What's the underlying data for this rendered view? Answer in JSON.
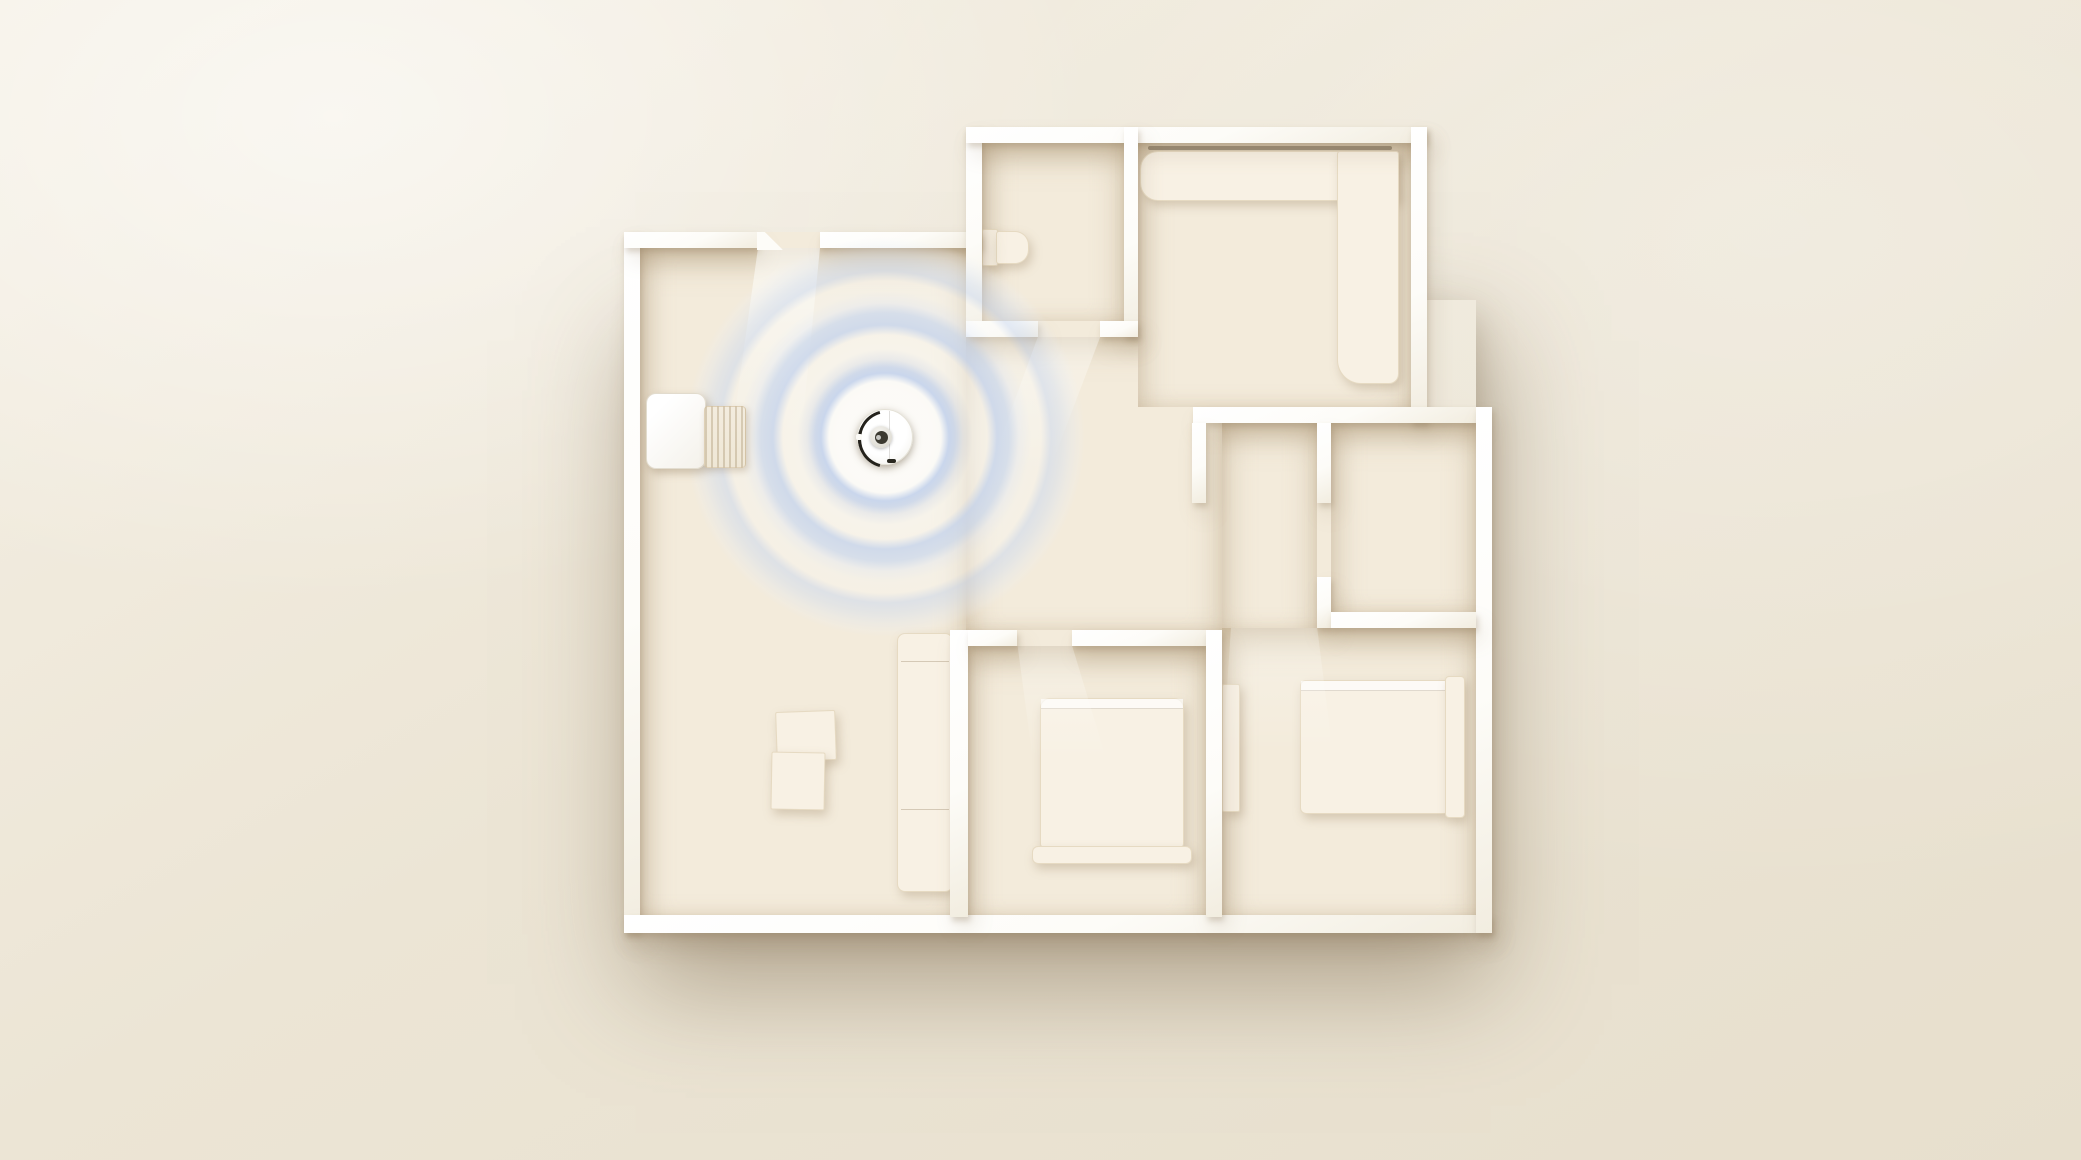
{
  "scene": {
    "kind": "3d-floorplan-render",
    "subject": "robot-vacuum-mapping-apartment",
    "rooms": [
      "living-room",
      "bathroom",
      "kitchen-dining",
      "hallway",
      "closet",
      "bedroom-1",
      "bedroom-2"
    ],
    "robot": {
      "x": 885,
      "y": 437,
      "diameter": 56
    },
    "rings": {
      "x": 885,
      "y": 437,
      "outer_radius": 200
    },
    "elements": [
      {
        "name": "living-room-floor",
        "cls": "floor",
        "x": 640,
        "y": 248,
        "w": 326,
        "h": 669
      },
      {
        "name": "corridor-floor",
        "cls": "floor",
        "x": 966,
        "y": 333,
        "w": 256,
        "h": 297
      },
      {
        "name": "hallway-floor",
        "cls": "floor",
        "x": 1222,
        "y": 423,
        "w": 95,
        "h": 207
      },
      {
        "name": "bathroom-floor",
        "cls": "floor",
        "x": 982,
        "y": 143,
        "w": 142,
        "h": 178
      },
      {
        "name": "kitchen-floor",
        "cls": "floor",
        "x": 1138,
        "y": 143,
        "w": 273,
        "h": 264
      },
      {
        "name": "closet-floor",
        "cls": "floor",
        "x": 1331,
        "y": 423,
        "w": 145,
        "h": 189
      },
      {
        "name": "bedroom1-floor",
        "cls": "floor",
        "x": 966,
        "y": 646,
        "w": 240,
        "h": 271
      },
      {
        "name": "bedroom2-floor",
        "cls": "floor",
        "x": 1222,
        "y": 628,
        "w": 254,
        "h": 289
      },
      {
        "name": "living-door-gap-floor",
        "cls": "patch",
        "x": 753,
        "y": 232,
        "w": 67,
        "h": 16
      },
      {
        "name": "bathroom-door-gap-floor",
        "cls": "patch",
        "x": 1038,
        "y": 321,
        "w": 62,
        "h": 16
      },
      {
        "name": "bedroom1-door-gap-floor",
        "cls": "patch",
        "x": 1017,
        "y": 630,
        "w": 55,
        "h": 16
      },
      {
        "name": "kitchen-opening-floor",
        "cls": "patch",
        "x": 1138,
        "y": 407,
        "w": 55,
        "h": 16
      },
      {
        "name": "closet-opening-floor",
        "cls": "patch",
        "x": 1317,
        "y": 503,
        "w": 14,
        "h": 109
      },
      {
        "name": "wall-outer-left",
        "cls": "wall",
        "x": 624,
        "y": 232,
        "w": 16,
        "h": 701
      },
      {
        "name": "wall-outer-bottom",
        "cls": "wall",
        "x": 624,
        "y": 915,
        "w": 868,
        "h": 18
      },
      {
        "name": "wall-living-top-a",
        "cls": "wall",
        "x": 624,
        "y": 232,
        "w": 133,
        "h": 16
      },
      {
        "name": "wall-living-top-b",
        "cls": "wall",
        "x": 820,
        "y": 232,
        "w": 162,
        "h": 16
      },
      {
        "name": "wall-bathroom-left",
        "cls": "wall",
        "x": 966,
        "y": 127,
        "w": 16,
        "h": 210
      },
      {
        "name": "wall-outer-top",
        "cls": "wall",
        "x": 966,
        "y": 127,
        "w": 461,
        "h": 16
      },
      {
        "name": "wall-bathroom-right",
        "cls": "wall",
        "x": 1124,
        "y": 127,
        "w": 14,
        "h": 210
      },
      {
        "name": "wall-bathroom-bottom-a",
        "cls": "wall",
        "x": 966,
        "y": 321,
        "w": 72,
        "h": 16
      },
      {
        "name": "wall-bathroom-bottom-b",
        "cls": "wall",
        "x": 1100,
        "y": 321,
        "w": 38,
        "h": 16
      },
      {
        "name": "wall-kitchen-right",
        "cls": "wall",
        "x": 1411,
        "y": 127,
        "w": 16,
        "h": 296
      },
      {
        "name": "wall-mid-top",
        "cls": "wall",
        "x": 1193,
        "y": 407,
        "w": 283,
        "h": 16
      },
      {
        "name": "wall-outer-right-lower",
        "cls": "wall",
        "x": 1476,
        "y": 407,
        "w": 16,
        "h": 526
      },
      {
        "name": "wall-hall-stub",
        "cls": "wall",
        "x": 1192,
        "y": 423,
        "w": 14,
        "h": 80
      },
      {
        "name": "wall-closet-left-top",
        "cls": "wall",
        "x": 1317,
        "y": 423,
        "w": 14,
        "h": 80
      },
      {
        "name": "wall-closet-left-bottom",
        "cls": "wall",
        "x": 1317,
        "y": 577,
        "w": 14,
        "h": 51
      },
      {
        "name": "wall-closet-bottom",
        "cls": "wall",
        "x": 1331,
        "y": 612,
        "w": 145,
        "h": 16
      },
      {
        "name": "wall-living-bedroom1-divider",
        "cls": "wall",
        "x": 950,
        "y": 630,
        "w": 18,
        "h": 287
      },
      {
        "name": "wall-bedroom1-top-a",
        "cls": "wall",
        "x": 968,
        "y": 630,
        "w": 49,
        "h": 16
      },
      {
        "name": "wall-bedroom1-top-b",
        "cls": "wall",
        "x": 1072,
        "y": 630,
        "w": 134,
        "h": 16
      },
      {
        "name": "wall-bedroom1-right",
        "cls": "wall",
        "x": 1206,
        "y": 630,
        "w": 16,
        "h": 287
      },
      {
        "name": "wall-door-endcap",
        "cls": "endcap",
        "x": 757,
        "y": 232,
        "w": 26,
        "h": 18,
        "clip": "polygon(0 0, 30% 0, 100% 100%, 0 100%)"
      },
      {
        "name": "toilet-tank",
        "cls": "furn",
        "x": 982,
        "y": 229,
        "w": 14,
        "h": 35,
        "r": "2px"
      },
      {
        "name": "toilet-bowl",
        "cls": "furn",
        "x": 996,
        "y": 231,
        "w": 31,
        "h": 31,
        "r": "3px 14px 14px 3px"
      },
      {
        "name": "kitchen-counter-top",
        "cls": "furn",
        "x": 1140,
        "y": 151,
        "w": 257,
        "h": 48,
        "r": "18px 3px 3px 18px"
      },
      {
        "name": "kitchen-counter-side",
        "cls": "furn",
        "x": 1337,
        "y": 151,
        "w": 60,
        "h": 231,
        "r": "3px 3px 10px 24px"
      },
      {
        "name": "counter-shadow-seam",
        "cls": "counter-seam",
        "x": 1148,
        "y": 146,
        "w": 244,
        "h": 4,
        "r": "2px",
        "bg": "rgba(90,75,55,.5)"
      },
      {
        "name": "coffee-table-1",
        "cls": "furn",
        "x": 776,
        "y": 711,
        "w": 58,
        "h": 48,
        "rot": -2,
        "r": "2px"
      },
      {
        "name": "coffee-table-2",
        "cls": "furn",
        "x": 771,
        "y": 752,
        "w": 52,
        "h": 56,
        "rot": 1,
        "r": "2px"
      },
      {
        "name": "living-sofa",
        "cls": "furn sofa",
        "x": 897,
        "y": 633,
        "w": 54,
        "h": 257,
        "r": "8px"
      },
      {
        "name": "bedroom1-bed",
        "cls": "furn bed-main",
        "x": 1040,
        "y": 698,
        "w": 142,
        "h": 148,
        "r": "10px 10px 4px 4px"
      },
      {
        "name": "bedroom1-bed-footboard",
        "cls": "furn",
        "x": 1032,
        "y": 846,
        "w": 158,
        "h": 16,
        "r": "6px"
      },
      {
        "name": "bedroom2-door-leaf",
        "cls": "furn",
        "x": 1222,
        "y": 684,
        "w": 16,
        "h": 126,
        "r": "2px"
      },
      {
        "name": "bedroom2-bed",
        "cls": "furn bed-main",
        "x": 1300,
        "y": 680,
        "w": 145,
        "h": 132,
        "r": "6px 3px 3px 6px"
      },
      {
        "name": "bedroom2-bed-headrail",
        "cls": "furn",
        "x": 1445,
        "y": 676,
        "w": 18,
        "h": 140,
        "r": "4px"
      },
      {
        "name": "charging-dock",
        "cls": "dock-body",
        "x": 646,
        "y": 393,
        "w": 58,
        "h": 74,
        "r": "10px",
        "z": 7
      },
      {
        "name": "dock-ramp",
        "cls": "dock-ramp",
        "x": 704,
        "y": 406,
        "w": 40,
        "h": 60,
        "r": "4px",
        "z": 7
      },
      {
        "name": "light-beam-living-door",
        "cls": "beam",
        "x": 728,
        "y": 248,
        "w": 100,
        "h": 200,
        "clip": "polygon(30% 0, 92% 0, 72% 100%, 2% 100%)",
        "op": 0.75
      },
      {
        "name": "light-beam-bathroom-door",
        "cls": "beam",
        "x": 985,
        "y": 337,
        "w": 120,
        "h": 145,
        "clip": "polygon(44% 0, 96% 0, 50% 100%, 0 100%)",
        "op": 0.5
      },
      {
        "name": "light-beam-bedroom1-door",
        "cls": "beam",
        "x": 1005,
        "y": 646,
        "w": 105,
        "h": 125,
        "clip": "polygon(12% 0, 64% 0, 100% 100%, 28% 100%)",
        "op": 0.4
      },
      {
        "name": "light-beam-bedroom2-door",
        "cls": "beam",
        "x": 1222,
        "y": 628,
        "w": 112,
        "h": 135,
        "clip": "polygon(8% 0, 85% 0, 100% 100%, 0 100%)",
        "op": 0.35
      }
    ]
  },
  "palette": {
    "background_light": "#f5f0e5",
    "background_mid": "#ece5d5",
    "background_dark": "#e7dfcd",
    "floor": "#f3ebdb",
    "wall_light": "#ffffff",
    "wall_shade": "#f2ede0",
    "furniture": "#f8f1e4",
    "ring_blue": "#c7d5ed",
    "robot_body": "#ffffff",
    "robot_bumper": "#24221c",
    "robot_lidar_dark": "#3c3a31"
  }
}
